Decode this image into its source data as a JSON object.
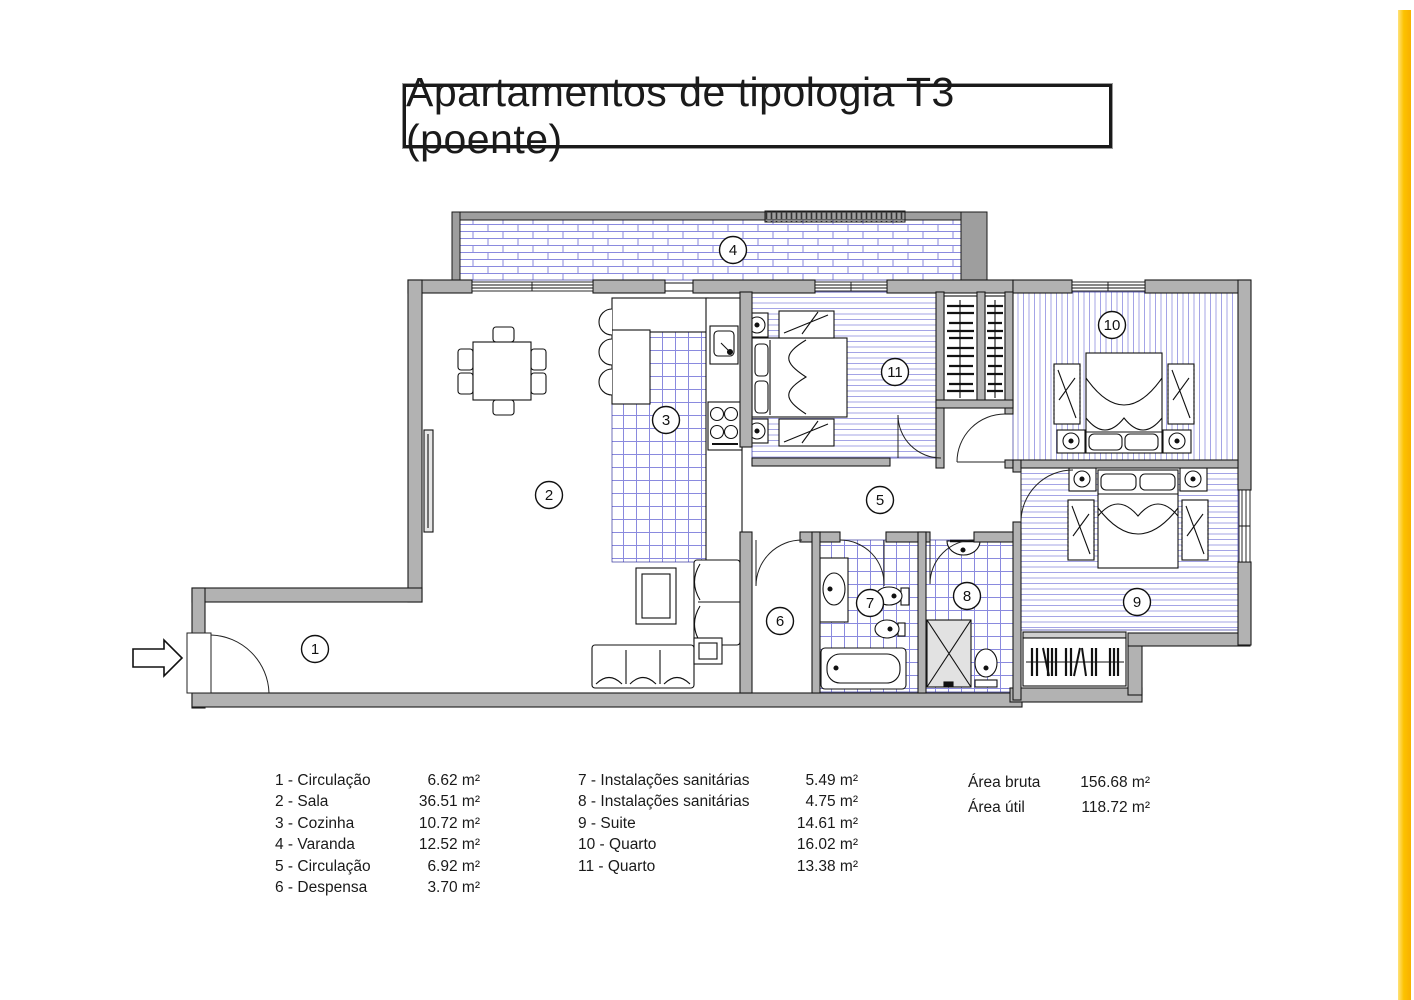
{
  "title": "Apartamentos de tipologia T3 (poente)",
  "plan": {
    "room_labels": [
      "1",
      "2",
      "3",
      "4",
      "5",
      "6",
      "7",
      "8",
      "9",
      "10",
      "11"
    ]
  },
  "legend": {
    "rooms_left": [
      {
        "label": "1 - Circulação",
        "area": "6.62 m²"
      },
      {
        "label": "2 - Sala",
        "area": "36.51 m²"
      },
      {
        "label": "3 - Cozinha",
        "area": "10.72 m²"
      },
      {
        "label": "4 - Varanda",
        "area": "12.52 m²"
      },
      {
        "label": "5 - Circulação",
        "area": "6.92 m²"
      },
      {
        "label": "6 - Despensa",
        "area": "3.70 m²"
      }
    ],
    "rooms_right": [
      {
        "label": "7 - Instalações sanitárias",
        "area": "5.49 m²"
      },
      {
        "label": "8 - Instalações sanitárias",
        "area": "4.75 m²"
      },
      {
        "label": "9 - Suite",
        "area": "14.61 m²"
      },
      {
        "label": "10 - Quarto",
        "area": "16.02 m²"
      },
      {
        "label": "11 - Quarto",
        "area": "13.38 m²"
      }
    ],
    "totals": [
      {
        "label": "Área bruta",
        "area": "156.68 m²"
      },
      {
        "label": "Área útil",
        "area": "118.72 m²"
      }
    ]
  },
  "colors": {
    "wall_gray": "#b2b2b2",
    "hatch_blue": "#8a8ade",
    "accent_stripe": "#fcc200"
  }
}
